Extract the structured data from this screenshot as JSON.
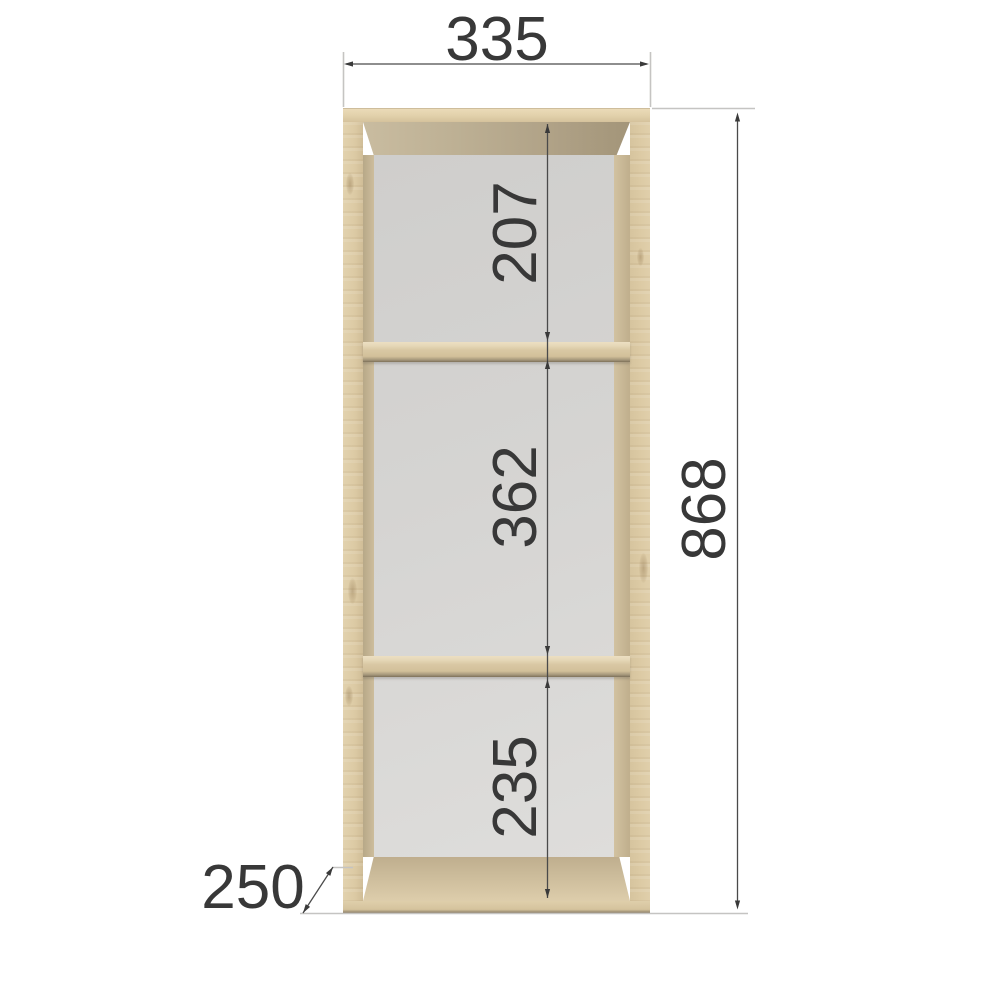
{
  "drawing": {
    "kind": "furniture dimension drawing",
    "subject": "three-compartment open wall shelf, front view"
  },
  "labels": {
    "width": "335",
    "height": "868",
    "depth": "250",
    "compartment_top": "207",
    "compartment_middle": "362",
    "compartment_bottom": "235"
  },
  "colors": {
    "background": "#ffffff",
    "wood_light": "#ddcba6",
    "wood_underside": "#b0a287",
    "back_panel": "#d6d5d3",
    "dimension_text": "#383838",
    "dimension_line": "#4a4a4a",
    "extension_line": "#c5c4c2"
  }
}
